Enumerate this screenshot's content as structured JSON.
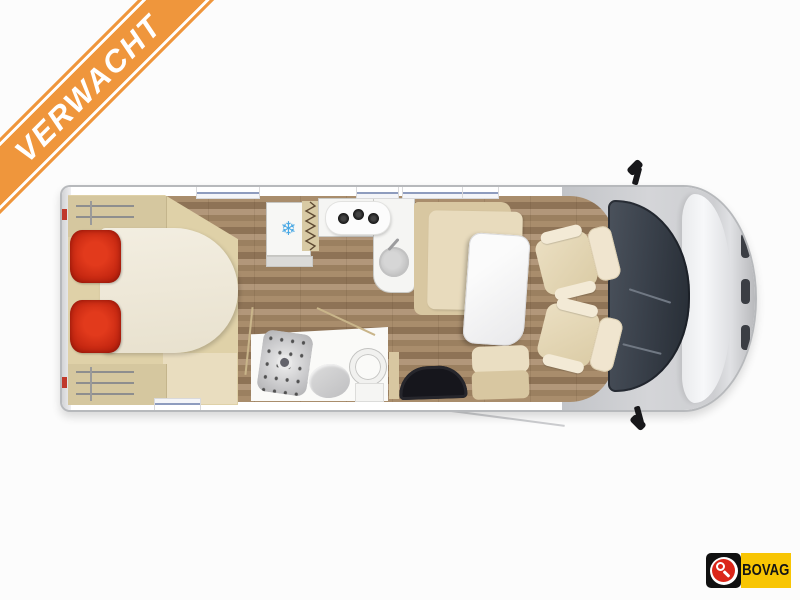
{
  "page": {
    "background": "#FCFCFC"
  },
  "banner": {
    "label": "VERWACHT",
    "bg_color": "#EF963C",
    "stripe_color": "#FFFFFF",
    "text_color": "#FFFFFF"
  },
  "bovag": {
    "label": "BOVAG",
    "panel_color": "#F8C503",
    "mark_bg": "#101010",
    "mark_disc_color": "#DB2619",
    "text_color": "#141414"
  },
  "floorplan": {
    "type": "motorhome-top-view-floor-plan",
    "orientation": "front-right",
    "body_color": "#FFFFFF",
    "outline_color": "#B7B9BC",
    "floor_color": "#A98D6C",
    "bed": {
      "style": "rear-island-bed",
      "mattress_color": "#F0EBDC",
      "pillow_count": 2,
      "pillow_color": "#C52711"
    },
    "wardrobe": {
      "rail_sets": 2,
      "cabinet_color": "#D5C79F"
    },
    "fridge": {
      "icon": "snowflake-icon",
      "icon_glyph": "❄",
      "icon_color": "#49A8E4"
    },
    "kitchen": {
      "burner_count": 3,
      "sink": "round",
      "counter_color": "#F5F5F3"
    },
    "bathroom": {
      "shower": true,
      "toilet": true,
      "washbasin": true,
      "tray_color": "#C9C9CB"
    },
    "dinette": {
      "bench_color": "#D8C7A1",
      "table_color": "#F5F5F6"
    },
    "entry": {
      "mat_color": "#16161C"
    },
    "cab": {
      "seat_count": 2,
      "seat_color": "#E2D4B4",
      "windshield_color": "#39414B",
      "hood_color": "#F2F3F5",
      "mirrors": 2
    },
    "windows_top": 4,
    "windows_bottom": 1
  }
}
